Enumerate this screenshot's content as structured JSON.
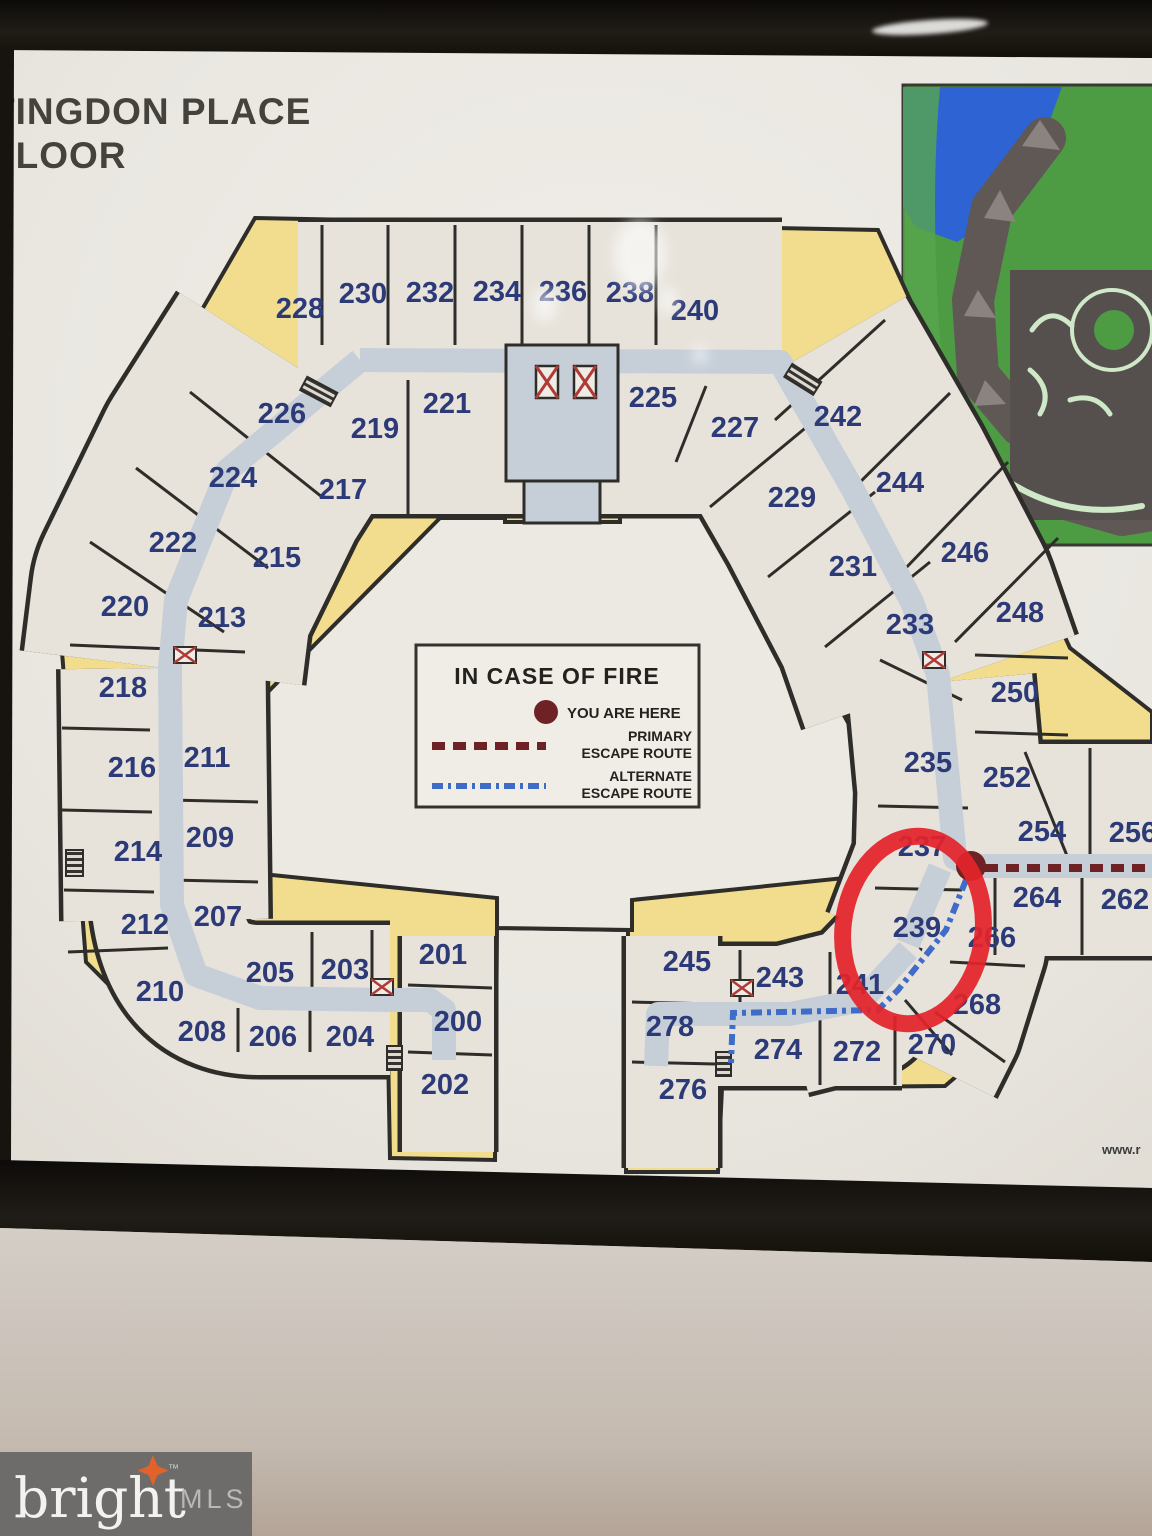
{
  "title": {
    "line1": "TINGDON PLACE",
    "line2": "FLOOR"
  },
  "legend": {
    "title": "IN CASE OF FIRE",
    "you_are_here": "YOU ARE HERE",
    "primary_l1": "PRIMARY",
    "primary_l2": "ESCAPE ROUTE",
    "alternate_l1": "ALTERNATE",
    "alternate_l2": "ESCAPE ROUTE"
  },
  "highlight": {
    "unit": "239",
    "circle_color": "#e3232b"
  },
  "watermark": {
    "brand": "bright",
    "tm": "™",
    "suffix": "MLS"
  },
  "url_fragment": "www.r",
  "colors": {
    "paper": "#ebe8e2",
    "balcony_yellow": "#f1dd8d",
    "room_cream": "#e7e3db",
    "corridor_blue": "#c6cfd8",
    "wall_dark": "#2e2d29",
    "unit_navy": "#2c3a78",
    "primary_route": "#6e2226",
    "alternate_route": "#3f6cc9",
    "frame_black": "#17130f",
    "sitemap_green": "#4d9c44",
    "sitemap_water": "#2e63d4",
    "sitemap_building": "#5f5855"
  },
  "units": [
    {
      "label": "228",
      "x": 300,
      "y": 309
    },
    {
      "label": "230",
      "x": 363,
      "y": 294
    },
    {
      "label": "232",
      "x": 430,
      "y": 293
    },
    {
      "label": "234",
      "x": 497,
      "y": 292
    },
    {
      "label": "236",
      "x": 563,
      "y": 292
    },
    {
      "label": "238",
      "x": 630,
      "y": 293
    },
    {
      "label": "240",
      "x": 695,
      "y": 311
    },
    {
      "label": "226",
      "x": 282,
      "y": 414
    },
    {
      "label": "224",
      "x": 233,
      "y": 478
    },
    {
      "label": "222",
      "x": 173,
      "y": 543
    },
    {
      "label": "220",
      "x": 125,
      "y": 607
    },
    {
      "label": "218",
      "x": 123,
      "y": 688
    },
    {
      "label": "216",
      "x": 132,
      "y": 768
    },
    {
      "label": "214",
      "x": 138,
      "y": 852
    },
    {
      "label": "212",
      "x": 145,
      "y": 925
    },
    {
      "label": "210",
      "x": 160,
      "y": 992
    },
    {
      "label": "208",
      "x": 202,
      "y": 1032
    },
    {
      "label": "206",
      "x": 273,
      "y": 1037
    },
    {
      "label": "204",
      "x": 350,
      "y": 1037
    },
    {
      "label": "219",
      "x": 375,
      "y": 429
    },
    {
      "label": "221",
      "x": 447,
      "y": 404
    },
    {
      "label": "225",
      "x": 653,
      "y": 398
    },
    {
      "label": "227",
      "x": 735,
      "y": 428
    },
    {
      "label": "229",
      "x": 792,
      "y": 498
    },
    {
      "label": "231",
      "x": 853,
      "y": 567
    },
    {
      "label": "233",
      "x": 910,
      "y": 625
    },
    {
      "label": "217",
      "x": 343,
      "y": 490
    },
    {
      "label": "215",
      "x": 277,
      "y": 558
    },
    {
      "label": "213",
      "x": 222,
      "y": 618
    },
    {
      "label": "211",
      "x": 207,
      "y": 758
    },
    {
      "label": "209",
      "x": 210,
      "y": 838
    },
    {
      "label": "207",
      "x": 218,
      "y": 917
    },
    {
      "label": "205",
      "x": 270,
      "y": 973
    },
    {
      "label": "203",
      "x": 345,
      "y": 970
    },
    {
      "label": "201",
      "x": 443,
      "y": 955
    },
    {
      "label": "200",
      "x": 458,
      "y": 1022
    },
    {
      "label": "202",
      "x": 445,
      "y": 1085
    },
    {
      "label": "242",
      "x": 838,
      "y": 417
    },
    {
      "label": "244",
      "x": 900,
      "y": 483
    },
    {
      "label": "246",
      "x": 965,
      "y": 553
    },
    {
      "label": "248",
      "x": 1020,
      "y": 613
    },
    {
      "label": "250",
      "x": 1015,
      "y": 693
    },
    {
      "label": "235",
      "x": 928,
      "y": 763
    },
    {
      "label": "237",
      "x": 922,
      "y": 847
    },
    {
      "label": "239",
      "x": 917,
      "y": 928
    },
    {
      "label": "241",
      "x": 860,
      "y": 985
    },
    {
      "label": "252",
      "x": 1007,
      "y": 778
    },
    {
      "label": "254",
      "x": 1042,
      "y": 832
    },
    {
      "label": "256",
      "x": 1133,
      "y": 833
    },
    {
      "label": "264",
      "x": 1037,
      "y": 898
    },
    {
      "label": "262",
      "x": 1125,
      "y": 900
    },
    {
      "label": "266",
      "x": 992,
      "y": 938
    },
    {
      "label": "268",
      "x": 977,
      "y": 1005
    },
    {
      "label": "245",
      "x": 687,
      "y": 962
    },
    {
      "label": "243",
      "x": 780,
      "y": 978
    },
    {
      "label": "278",
      "x": 670,
      "y": 1027
    },
    {
      "label": "274",
      "x": 778,
      "y": 1050
    },
    {
      "label": "272",
      "x": 857,
      "y": 1052
    },
    {
      "label": "270",
      "x": 932,
      "y": 1045
    },
    {
      "label": "276",
      "x": 683,
      "y": 1090
    }
  ]
}
